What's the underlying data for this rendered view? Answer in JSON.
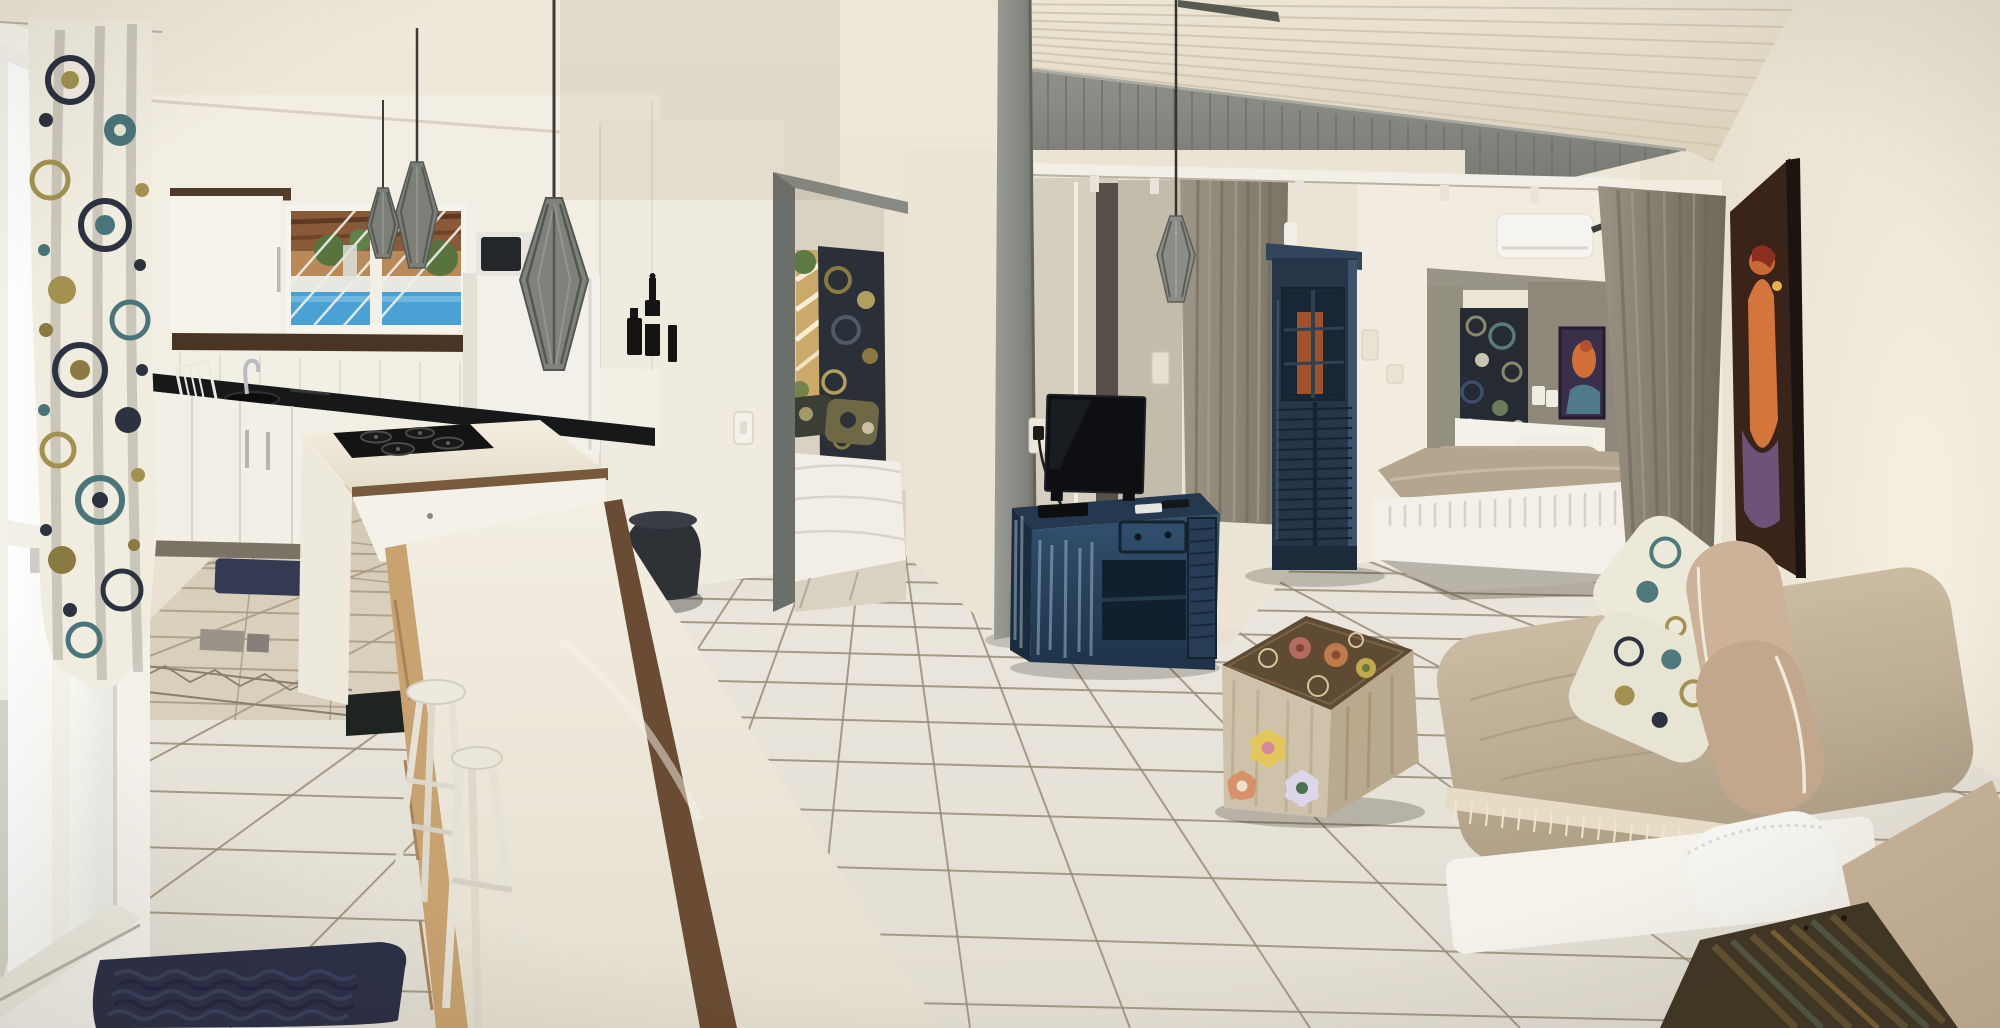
{
  "image_type": "photograph",
  "scene": {
    "title": "apartment-interior-panorama",
    "description": "Wide-angle interior photo of a bright vacation apartment: open kitchen on the left, living area in the middle, two bedroom areas and a daybed on the right. White tiled floor, cream walls, vaulted plank ceiling with gray gable.",
    "rooms": [
      "kitchen",
      "living-area",
      "bedroom-middle",
      "bedroom-back"
    ]
  },
  "palette": {
    "wall_cream": "#ece5d6",
    "ceiling_plank": "#e9e1d0",
    "gable_gray": "#858880",
    "column_gray": "#8b8e86",
    "floor_tile": "#e9e5dc",
    "grout": "#8a7f6c",
    "counter_black": "#17181a",
    "cabinet_white": "#f3f0e7",
    "wood_trim": "#6a4c34",
    "console_blue": "#2b4460",
    "wardrobe_navy": "#263648",
    "curtain_taupe": "#8f887a",
    "daybed_beige": "#c3b29a",
    "pool_blue": "#4aa2d4",
    "rug_navy": "#2d3147",
    "painting_bg": "#3a2318",
    "painting_figure": "#d4763c"
  },
  "objects": [
    {
      "name": "sliding-glass-door",
      "label": "white sliding glass door, bright daylight",
      "color": "#fdfdfa"
    },
    {
      "name": "floral-curtain-left",
      "label": "white curtain with navy/teal/olive medallion print",
      "color": "#f0ece0"
    },
    {
      "name": "upper-cabinet",
      "label": "white upper cabinet with dark wood frame",
      "color": "#f6f3ea"
    },
    {
      "name": "kitchen-window",
      "label": "window over sink showing pergola and blue pool",
      "color": "#4aa2d4"
    },
    {
      "name": "pendant-lamp",
      "label": "gray slatted bicone pendant lamps (4)",
      "color": "#7c7f78"
    },
    {
      "name": "fridge",
      "label": "white refrigerator with microwave on top",
      "color": "#f3f0e9"
    },
    {
      "name": "black-countertop",
      "label": "black granite countertop with sink and faucet",
      "color": "#17181a"
    },
    {
      "name": "kitchen-island",
      "label": "white island with black 4-burner gas cooktop and wood trim",
      "color": "#efe9d9"
    },
    {
      "name": "long-table",
      "label": "long white table with wood edge and brown panel base",
      "color": "#f1ece0"
    },
    {
      "name": "white-stools",
      "label": "two white wooden stools",
      "color": "#eceade"
    },
    {
      "name": "bottle-decals",
      "label": "black bottle wall decals",
      "color": "#141414"
    },
    {
      "name": "middle-bedroom-doorway",
      "label": "doorway with gray sliding door, patterned curtain and bed inside",
      "color": "#6b6f6a"
    },
    {
      "name": "dark-pouf",
      "label": "dark round pouf/bin by the wall",
      "color": "#2e3136"
    },
    {
      "name": "gray-column",
      "label": "gray structural column floor to ceiling",
      "color": "#8b8e86"
    },
    {
      "name": "gable-plank-wall",
      "label": "gray vertical-plank gable under vaulted ceiling",
      "color": "#858880"
    },
    {
      "name": "curtain-rail",
      "label": "white curtain rail with hooks",
      "color": "#f2efe6"
    },
    {
      "name": "tv",
      "label": "flat-screen TV",
      "color": "#0d0f12"
    },
    {
      "name": "tv-console-blue",
      "label": "distressed blue console with drawer and louver door",
      "color": "#2b4460"
    },
    {
      "name": "wardrobe-blue",
      "label": "tall dark-blue louvered wardrobe with white bottle on top",
      "color": "#263648"
    },
    {
      "name": "ac-unit",
      "label": "white mini-split air conditioner",
      "color": "#f6f4ee"
    },
    {
      "name": "ceiling-fan",
      "label": "ceiling fan blades near AC",
      "color": "#3c3e3a"
    },
    {
      "name": "tapestry-alcove",
      "label": "dark medallion tapestry in gray alcove",
      "color": "#252a33"
    },
    {
      "name": "alcove-painting",
      "label": "small colorful figure painting in alcove",
      "color": "#3a2f4a"
    },
    {
      "name": "twin-beds",
      "label": "two beds with taupe covers and white fringed skirt",
      "color": "#b4a58f"
    },
    {
      "name": "gray-curtain-right",
      "label": "floor-length taupe-gray curtain panel",
      "color": "#8f887a"
    },
    {
      "name": "right-wall-painting",
      "label": "canvas with orange figure on dark background, seen edge-on",
      "color": "#3a2318"
    },
    {
      "name": "painted-chest",
      "label": "whitewashed wooden chest painted with flowers",
      "color": "#cfc2ab"
    },
    {
      "name": "daybed",
      "label": "beige daybed with fringe throw, tan bolsters and floral pillows",
      "color": "#c3b29a"
    },
    {
      "name": "floral-pillows",
      "label": "white pillows with teal/olive medallion print",
      "color": "#ece8da"
    },
    {
      "name": "side-table-rustic",
      "label": "rustic multicolor wood side table",
      "color": "#433826"
    },
    {
      "name": "shag-rug",
      "label": "navy shag rug on tile floor",
      "color": "#2d3147"
    },
    {
      "name": "kitchen-rugs",
      "label": "two small dark mats in kitchen",
      "color": "#39405a"
    },
    {
      "name": "tile-floor",
      "label": "white square tile floor with dark grout, decorative band near kitchen",
      "color": "#e9e5dc"
    }
  ]
}
